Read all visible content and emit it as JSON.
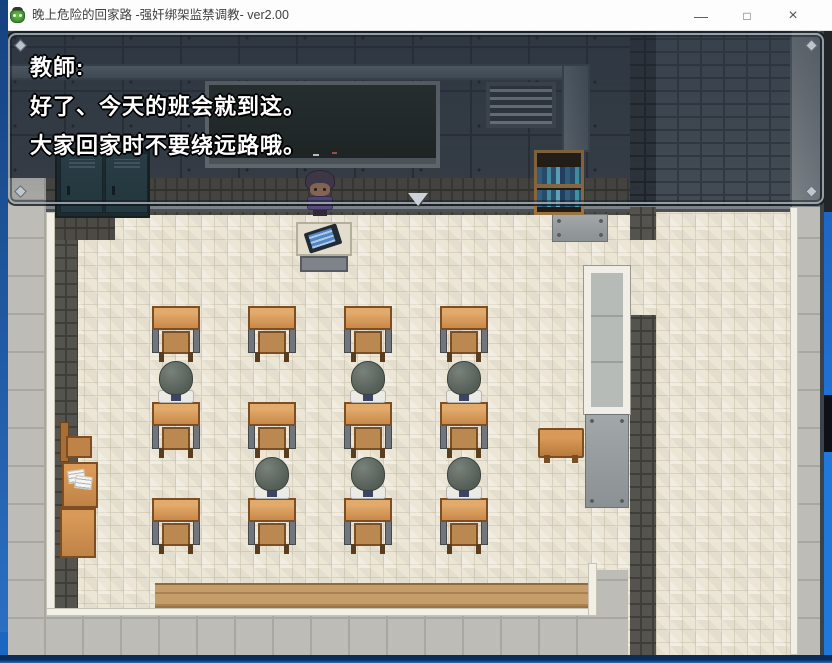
{
  "window": {
    "title": "晚上危险的回家路 -强奸绑架监禁调教- ver2.00",
    "controls": {
      "minimize": "—",
      "maximize": "□",
      "close": "×"
    }
  },
  "dialog": {
    "lines": [
      "教師:",
      "好了、今天的班会就到这。",
      "大家回家时不要绕远路哦。"
    ]
  },
  "classroom": {
    "desk_cols": [
      144,
      240,
      336,
      432
    ],
    "desk_rows": [
      275,
      371,
      467
    ],
    "student_row_y": [
      330,
      426
    ],
    "students": [
      {
        "col": 0,
        "row": 0
      },
      {
        "col": 2,
        "row": 0
      },
      {
        "col": 3,
        "row": 0
      },
      {
        "col": 1,
        "row": 1
      },
      {
        "col": 2,
        "row": 1
      },
      {
        "col": 3,
        "row": 1
      }
    ]
  },
  "colors": {
    "desktop_blue": "#1b66c0",
    "titlebar": "#fdfdfd",
    "wall_dark": "#3a424a",
    "floor_cream": "#ece6d7",
    "corridor_stone": "#bdbcb7",
    "wood": "#c8894a",
    "dialog_border": "#a5afb9",
    "dialog_fill": "rgba(28,38,50,0.35)"
  }
}
